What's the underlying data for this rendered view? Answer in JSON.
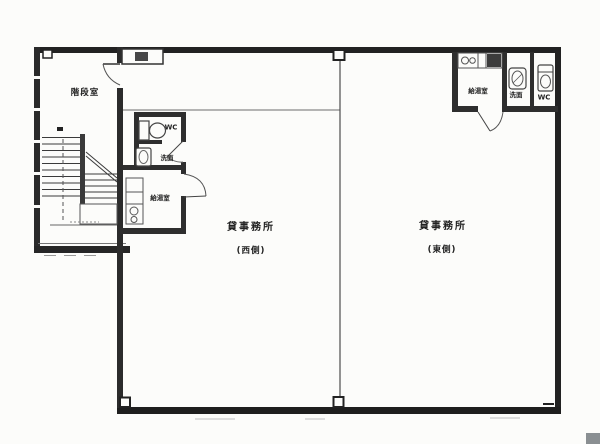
{
  "plan_title": "floor-plan",
  "rooms": {
    "stairwell": {
      "name": "階段室"
    },
    "west_unit": {
      "office": "貸事務所",
      "side": "(西側)",
      "wc": "WC",
      "washroom": "洗面",
      "kitchenette": "給湯室"
    },
    "east_unit": {
      "office": "貸事務所",
      "side": "(東側)",
      "wc": "WC",
      "washroom": "洗面",
      "kitchenette": "給湯室"
    }
  },
  "colors": {
    "outer_wall": "#222222",
    "inner_wall": "#2e2e2e",
    "beam_line": "#9b9b9b",
    "partition": "#4c4c4c",
    "paper": "#fcfcfa",
    "scan_artifact": "#8a8f92"
  }
}
